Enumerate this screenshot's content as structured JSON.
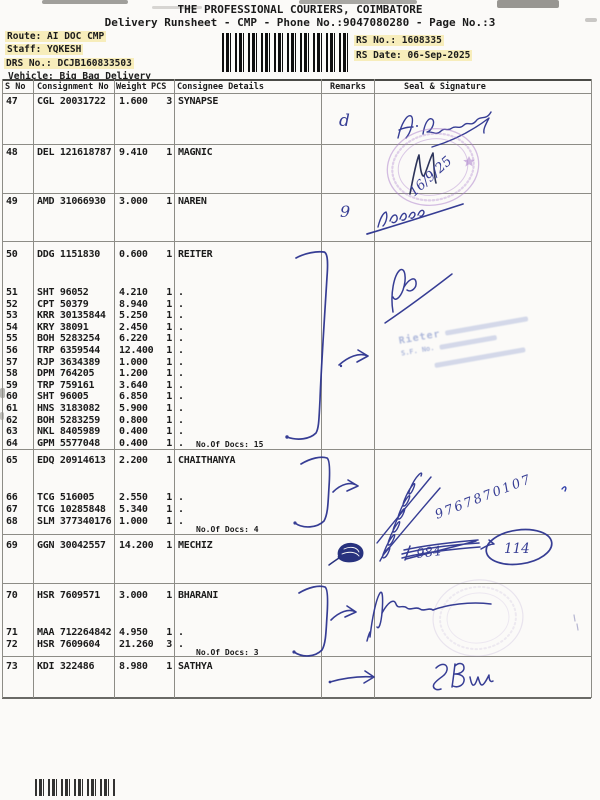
{
  "page": {
    "title": "THE PROFESSIONAL COURIERS, COIMBATORE",
    "subtitle": "Delivery Runsheet - CMP - Phone No.:9047080280 - Page No.:3",
    "route": "Route: AI DOC CMP",
    "staff": "Staff: YQKESH",
    "drs_no": "DRS No.: DCJB160833503",
    "vehicle": "Vehicle: Big Bag Delivery",
    "rs_no": "RS No.: 1608335",
    "rs_date": "RS Date: 06-Sep-2025"
  },
  "table": {
    "headers": [
      "S No",
      "Consignment No",
      "Weight",
      "PCS",
      "Consignee Details",
      "Remarks",
      "Seal & Signature"
    ],
    "groups": [
      {
        "rows": [
          {
            "sno": "47",
            "consignment": "CGL 20031722",
            "weight": "1.600",
            "pcs": "3",
            "consignee": "SYNAPSE"
          }
        ]
      },
      {
        "rows": [
          {
            "sno": "48",
            "consignment": "DEL 121618787",
            "weight": "9.410",
            "pcs": "1",
            "consignee": "MAGNIC"
          }
        ]
      },
      {
        "rows": [
          {
            "sno": "49",
            "consignment": "AMD 31066930",
            "weight": "3.000",
            "pcs": "1",
            "consignee": "NAREN"
          }
        ]
      },
      {
        "rows": [
          {
            "sno": "50",
            "consignment": "DDG 1151830",
            "weight": "0.600",
            "pcs": "1",
            "consignee": "REITER"
          },
          {
            "sno": "51",
            "consignment": "SHT 96052",
            "weight": "4.210",
            "pcs": "1",
            "consignee": "."
          },
          {
            "sno": "52",
            "consignment": "CPT 50379",
            "weight": "8.940",
            "pcs": "1",
            "consignee": "."
          },
          {
            "sno": "53",
            "consignment": "KRR 30135844",
            "weight": "5.250",
            "pcs": "1",
            "consignee": "."
          },
          {
            "sno": "54",
            "consignment": "KRY 38091",
            "weight": "2.450",
            "pcs": "1",
            "consignee": "."
          },
          {
            "sno": "55",
            "consignment": "BOH 5283254",
            "weight": "6.220",
            "pcs": "1",
            "consignee": "."
          },
          {
            "sno": "56",
            "consignment": "TRP 6359544",
            "weight": "12.400",
            "pcs": "1",
            "consignee": "."
          },
          {
            "sno": "57",
            "consignment": "RJP 3634389",
            "weight": "1.000",
            "pcs": "1",
            "consignee": "."
          },
          {
            "sno": "58",
            "consignment": "DPM 764205",
            "weight": "1.200",
            "pcs": "1",
            "consignee": "."
          },
          {
            "sno": "59",
            "consignment": "TRP 759161",
            "weight": "3.640",
            "pcs": "1",
            "consignee": "."
          },
          {
            "sno": "60",
            "consignment": "SHT 96005",
            "weight": "6.850",
            "pcs": "1",
            "consignee": "."
          },
          {
            "sno": "61",
            "consignment": "HNS 3183082",
            "weight": "5.900",
            "pcs": "1",
            "consignee": "."
          },
          {
            "sno": "62",
            "consignment": "BOH 5283259",
            "weight": "0.800",
            "pcs": "1",
            "consignee": "."
          },
          {
            "sno": "63",
            "consignment": "NKL 8405989",
            "weight": "0.400",
            "pcs": "1",
            "consignee": "."
          },
          {
            "sno": "64",
            "consignment": "GPM 5577048",
            "weight": "0.400",
            "pcs": "1",
            "consignee": "."
          }
        ],
        "docs_note": "No.Of Docs: 15"
      },
      {
        "rows": [
          {
            "sno": "65",
            "consignment": "EDQ 20914613",
            "weight": "2.200",
            "pcs": "1",
            "consignee": "CHAITHANYA"
          },
          {
            "sno": "66",
            "consignment": "TCG 516005",
            "weight": "2.550",
            "pcs": "1",
            "consignee": "."
          },
          {
            "sno": "67",
            "consignment": "TCG 10285848",
            "weight": "5.340",
            "pcs": "1",
            "consignee": "."
          },
          {
            "sno": "68",
            "consignment": "SLM 377340176",
            "weight": "1.000",
            "pcs": "1",
            "consignee": "."
          }
        ],
        "docs_note": "No.Of Docs: 4"
      },
      {
        "rows": [
          {
            "sno": "69",
            "consignment": "GGN 30042557",
            "weight": "14.200",
            "pcs": "1",
            "consignee": "MECHIZ"
          }
        ]
      },
      {
        "rows": [
          {
            "sno": "70",
            "consignment": "HSR 7609571",
            "weight": "3.000",
            "pcs": "1",
            "consignee": "BHARANI"
          },
          {
            "sno": "71",
            "consignment": "MAA 712264842",
            "weight": "4.950",
            "pcs": "1",
            "consignee": "."
          },
          {
            "sno": "72",
            "consignment": "HSR 7609604",
            "weight": "21.260",
            "pcs": "3",
            "consignee": "."
          }
        ],
        "docs_note": "No.Of Docs: 3"
      },
      {
        "rows": [
          {
            "sno": "73",
            "consignment": "KDI 322486",
            "weight": "8.980",
            "pcs": "1",
            "consignee": "SATHYA"
          }
        ]
      }
    ]
  },
  "handwriting": {
    "remark_47": "d",
    "remark_49": "9",
    "date_row48": "16/9/25",
    "phone": "9767870107",
    "crossed_69": "984",
    "circled_69": "114",
    "stamp_company": "Rieter",
    "stamp_line2": "S.F. No."
  },
  "colors": {
    "ink_blue": "#2c338f",
    "stamp_purple": "#a678c8",
    "stamp_blue": "#6c80c2",
    "highlight": "#f7edbb"
  }
}
